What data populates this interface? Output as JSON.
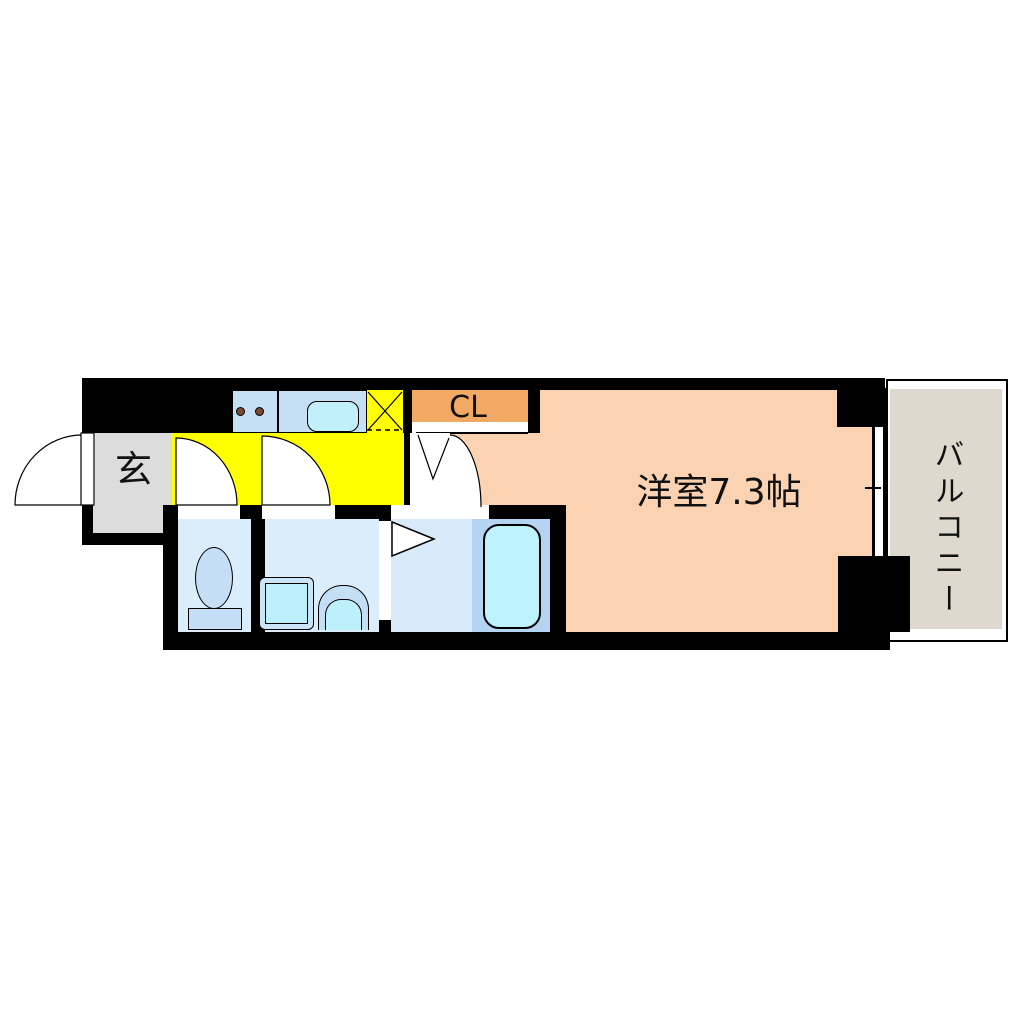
{
  "plan": {
    "genkan": {
      "label": "玄"
    },
    "closet": {
      "label": "CL"
    },
    "main_room": {
      "label": "洋室7.3帖"
    },
    "balcony": {
      "label": "バルコニー"
    }
  },
  "fixtures": {
    "stove_burners": 2,
    "items": [
      "kitchen-stove",
      "kitchen-sink",
      "refrigerator-space",
      "toilet",
      "washing-machine-space",
      "washbasin",
      "bathtub"
    ]
  },
  "colors": {
    "wall": "#000000",
    "genkan_floor": "#dcdcdc",
    "kitchen_floor": "#ffff00",
    "counter": "#c5dff5",
    "sink": "#c2f0fa",
    "burner": "#7b4a2d",
    "closet": "#f2a964",
    "room_floor": "#fbd3b3",
    "balcony_floor": "#ded8ce",
    "wet_floor": "#dbedfb",
    "bath_floor": "#d8eafa",
    "tub_deck": "#b5d4f1",
    "tub": "#bef2fc",
    "fixture": "#c4def5",
    "fixture_inner": "#bdf0fa"
  }
}
